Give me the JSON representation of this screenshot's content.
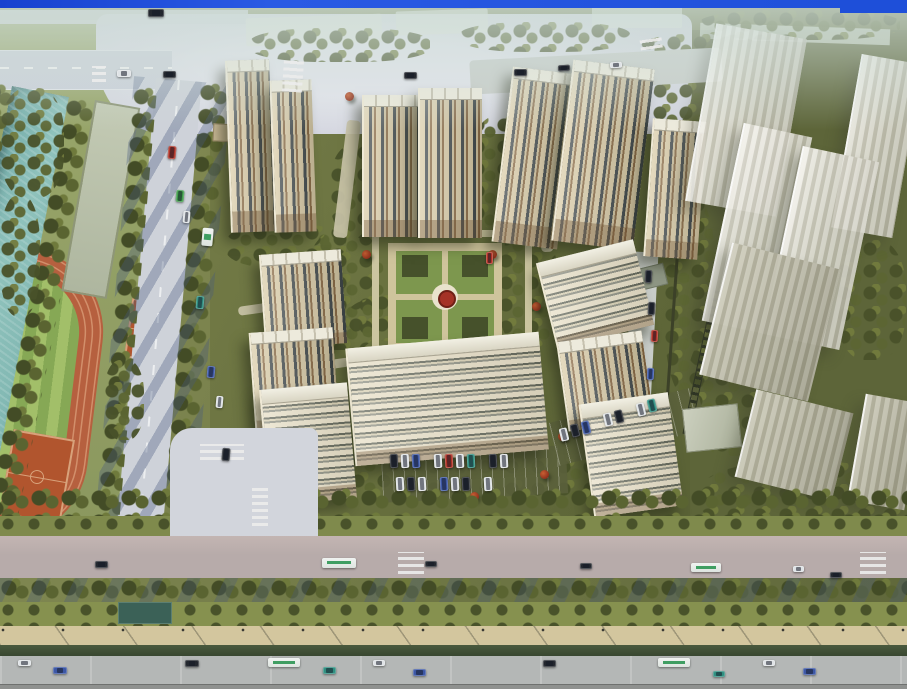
{
  "scene": {
    "type": "aerial-architectural-rendering",
    "description": "Bird's-eye rendering of a residential high-rise complex with central formal garden, canal and sports park to the west, translucent future-phase towers to the east, tree-lined arterial road along the south",
    "palette": {
      "frame_blue": "#1e4fd9",
      "water_teal": "#7fb5b0",
      "track_red": "#b6603f",
      "court_clay": "#b1552e",
      "field_green_light": "#a2bf69",
      "field_green_dark": "#86a855",
      "building_cream": "#d9cba6",
      "building_window": "#41494b",
      "building_roof_white": "#edeadc",
      "ghost_white": "#e8e6da",
      "ghost_olive": "#b0ae9a",
      "plaza_gray": "#d5d7e0",
      "road_gray": "#ccd1da",
      "arterial_gray": "#b4b7b6",
      "ground_olive": "#6b7342",
      "park_green": "#93a066",
      "lawn_green": "#86914f",
      "hedge_dark": "#3e4a33",
      "tree_olive": "#5a6431",
      "tree_dark": "#434c26",
      "shadow_blue": "#46587d",
      "accent_tree_red": "#a8442a",
      "path_tan": "#d3c69e",
      "garden_path": "#cfc49c",
      "garden_feature_red": "#a53226",
      "pond_teal": "#3b6157",
      "car_white": "#dfe3e6",
      "car_dark": "#23272e",
      "car_blue": "#3c57a6",
      "car_teal": "#2f8f80",
      "car_red": "#b03226",
      "car_green": "#3f9e49",
      "bus_green": "#3f9e62"
    },
    "main_buildings": [
      {
        "x": 228,
        "y": 60,
        "w": 42,
        "h": 172,
        "r": -2
      },
      {
        "x": 272,
        "y": 80,
        "w": 40,
        "h": 152,
        "r": -2
      },
      {
        "x": 362,
        "y": 95,
        "w": 58,
        "h": 142,
        "r": 0
      },
      {
        "x": 418,
        "y": 88,
        "w": 62,
        "h": 150,
        "r": 0
      },
      {
        "x": 502,
        "y": 70,
        "w": 64,
        "h": 176,
        "r": 7
      },
      {
        "x": 562,
        "y": 64,
        "w": 80,
        "h": 182,
        "r": 7
      },
      {
        "x": 648,
        "y": 120,
        "w": 52,
        "h": 138,
        "r": 4
      },
      {
        "x": 262,
        "y": 252,
        "w": 80,
        "h": 94,
        "r": -4
      },
      {
        "x": 252,
        "y": 330,
        "w": 82,
        "h": 100,
        "r": -4
      },
      {
        "x": 545,
        "y": 250,
        "w": 98,
        "h": 88,
        "r": -14,
        "v": "lit"
      },
      {
        "x": 562,
        "y": 336,
        "w": 84,
        "h": 90,
        "r": -8
      },
      {
        "x": 350,
        "y": 340,
        "w": 192,
        "h": 118,
        "r": -5,
        "v": "lit"
      },
      {
        "x": 264,
        "y": 386,
        "w": 86,
        "h": 116,
        "r": -5,
        "v": "lit"
      },
      {
        "x": 586,
        "y": 398,
        "w": 88,
        "h": 114,
        "r": -8,
        "v": "lit"
      }
    ],
    "ghost_buildings": [
      {
        "x": 700,
        "y": 30,
        "w": 90,
        "h": 180,
        "r": 10
      },
      {
        "x": 846,
        "y": 58,
        "w": 60,
        "h": 176,
        "r": 10
      },
      {
        "x": 722,
        "y": 128,
        "w": 68,
        "h": 202,
        "r": 12
      },
      {
        "x": 782,
        "y": 152,
        "w": 76,
        "h": 192,
        "r": 12
      },
      {
        "x": 714,
        "y": 254,
        "w": 110,
        "h": 136,
        "r": 14,
        "v": "olive"
      },
      {
        "x": 744,
        "y": 400,
        "w": 98,
        "h": 90,
        "r": 14,
        "v": "olive"
      },
      {
        "x": 856,
        "y": 398,
        "w": 56,
        "h": 108,
        "r": 10,
        "v": "olive"
      }
    ],
    "groves": [
      {
        "x": 250,
        "y": 28,
        "w": 180,
        "h": 34
      },
      {
        "x": 460,
        "y": 22,
        "w": 170,
        "h": 30
      },
      {
        "x": 640,
        "y": 34,
        "w": 120,
        "h": 34
      },
      {
        "x": 700,
        "y": 10,
        "w": 200,
        "h": 30
      },
      {
        "x": 226,
        "y": 224,
        "w": 120,
        "h": 44
      },
      {
        "x": 330,
        "y": 144,
        "w": 58,
        "h": 94
      },
      {
        "x": 470,
        "y": 116,
        "w": 64,
        "h": 114
      },
      {
        "x": 306,
        "y": 230,
        "w": 78,
        "h": 120
      },
      {
        "x": 498,
        "y": 230,
        "w": 60,
        "h": 118
      },
      {
        "x": 348,
        "y": 294,
        "w": 146,
        "h": 48
      },
      {
        "x": 298,
        "y": 428,
        "w": 126,
        "h": 62
      },
      {
        "x": 426,
        "y": 458,
        "w": 210,
        "h": 42
      },
      {
        "x": 238,
        "y": 150,
        "w": 40,
        "h": 80
      },
      {
        "x": 652,
        "y": 60,
        "w": 56,
        "h": 130
      },
      {
        "x": 664,
        "y": 196,
        "w": 52,
        "h": 200
      },
      {
        "x": 688,
        "y": 326,
        "w": 100,
        "h": 130
      },
      {
        "x": 700,
        "y": 462,
        "w": 207,
        "h": 70
      },
      {
        "x": 836,
        "y": 240,
        "w": 70,
        "h": 120
      },
      {
        "x": 0,
        "y": 88,
        "w": 64,
        "h": 110
      },
      {
        "x": 0,
        "y": 196,
        "w": 40,
        "h": 120
      },
      {
        "x": 104,
        "y": 360,
        "w": 40,
        "h": 80
      },
      {
        "x": 0,
        "y": 520,
        "w": 170,
        "h": 44
      }
    ],
    "paths": [
      {
        "x": 340,
        "y": 120,
        "w": 14,
        "h": 118,
        "r": 7
      },
      {
        "x": 538,
        "y": 150,
        "w": 12,
        "h": 102,
        "r": -4
      },
      {
        "x": 444,
        "y": 350,
        "w": 10,
        "h": 62
      },
      {
        "x": 326,
        "y": 354,
        "w": 94,
        "h": 9,
        "r": -8
      },
      {
        "x": 238,
        "y": 302,
        "w": 70,
        "h": 9,
        "r": -8
      },
      {
        "x": 628,
        "y": 252,
        "w": 26,
        "h": 172,
        "r": 3,
        "v": "road"
      },
      {
        "x": 470,
        "y": 54,
        "w": 252,
        "h": 34,
        "r": -3,
        "v": "road"
      }
    ],
    "accent_trees": [
      {
        "x": 345,
        "y": 92
      },
      {
        "x": 424,
        "y": 104
      },
      {
        "x": 522,
        "y": 204
      },
      {
        "x": 302,
        "y": 272
      },
      {
        "x": 532,
        "y": 302
      },
      {
        "x": 415,
        "y": 357
      },
      {
        "x": 558,
        "y": 432
      },
      {
        "x": 302,
        "y": 442
      },
      {
        "x": 470,
        "y": 492
      },
      {
        "x": 608,
        "y": 300
      },
      {
        "x": 362,
        "y": 250
      },
      {
        "x": 488,
        "y": 250
      },
      {
        "x": 330,
        "y": 478
      },
      {
        "x": 540,
        "y": 470
      },
      {
        "x": 652,
        "y": 214
      },
      {
        "x": 296,
        "y": 180
      }
    ],
    "crosswalks": [
      {
        "x": 283,
        "y": 58,
        "w": 20,
        "h": 34,
        "r": 4
      },
      {
        "x": 92,
        "y": 66,
        "w": 14,
        "h": 16
      },
      {
        "x": 200,
        "y": 444,
        "w": 44,
        "h": 16
      },
      {
        "x": 252,
        "y": 488,
        "w": 16,
        "h": 38
      },
      {
        "x": 398,
        "y": 552,
        "w": 26,
        "h": 22
      },
      {
        "x": 860,
        "y": 552,
        "w": 26,
        "h": 22
      },
      {
        "x": 640,
        "y": 36,
        "w": 22,
        "h": 13,
        "r": -8
      }
    ],
    "cars": [
      {
        "x": 117,
        "y": 70,
        "w": 14,
        "h": 7,
        "c": "#dfe3e6"
      },
      {
        "x": 163,
        "y": 71,
        "w": 13,
        "h": 7,
        "c": "#23272e"
      },
      {
        "x": 404,
        "y": 72,
        "w": 13,
        "h": 7,
        "c": "#23272e"
      },
      {
        "x": 514,
        "y": 69,
        "w": 13,
        "h": 7,
        "c": "#23272e"
      },
      {
        "x": 148,
        "y": 9,
        "w": 16,
        "h": 8,
        "c": "#23272e"
      },
      {
        "x": 558,
        "y": 65,
        "w": 12,
        "h": 6,
        "r": -3,
        "c": "#23272e"
      },
      {
        "x": 610,
        "y": 62,
        "w": 12,
        "h": 6,
        "r": -3,
        "c": "#dfe3e6"
      },
      {
        "x": 168,
        "y": 146,
        "w": 8,
        "h": 13,
        "r": 5,
        "c": "#b03226"
      },
      {
        "x": 176,
        "y": 190,
        "w": 8,
        "h": 12,
        "r": 5,
        "c": "#3f9e49"
      },
      {
        "x": 183,
        "y": 211,
        "w": 7,
        "h": 12,
        "r": 5,
        "c": "#dfe3e6"
      },
      {
        "x": 196,
        "y": 296,
        "w": 8,
        "h": 13,
        "r": 5,
        "c": "#2f8f80"
      },
      {
        "x": 207,
        "y": 366,
        "w": 8,
        "h": 12,
        "r": 5,
        "c": "#3c57a6"
      },
      {
        "x": 216,
        "y": 396,
        "w": 7,
        "h": 12,
        "r": 5,
        "c": "#dfe3e6"
      },
      {
        "x": 222,
        "y": 448,
        "w": 8,
        "h": 13,
        "r": 5,
        "c": "#23272e"
      },
      {
        "x": 645,
        "y": 270,
        "w": 7,
        "h": 13,
        "r": 3,
        "c": "#23272e"
      },
      {
        "x": 648,
        "y": 302,
        "w": 7,
        "h": 13,
        "r": 3,
        "c": "#23272e"
      },
      {
        "x": 651,
        "y": 330,
        "w": 7,
        "h": 12,
        "r": 3,
        "c": "#b03226"
      },
      {
        "x": 647,
        "y": 368,
        "w": 7,
        "h": 12,
        "r": 3,
        "c": "#3c57a6"
      },
      {
        "x": 486,
        "y": 252,
        "w": 7,
        "h": 12,
        "c": "#b03226"
      },
      {
        "x": 390,
        "y": 454,
        "w": 8,
        "h": 14,
        "r": -3,
        "c": "#23272e"
      },
      {
        "x": 401,
        "y": 454,
        "w": 8,
        "h": 14,
        "r": -3,
        "c": "#dfe3e6"
      },
      {
        "x": 412,
        "y": 454,
        "w": 8,
        "h": 14,
        "r": -3,
        "c": "#3c57a6"
      },
      {
        "x": 434,
        "y": 454,
        "w": 8,
        "h": 14,
        "r": -3,
        "c": "#dfe3e6"
      },
      {
        "x": 445,
        "y": 454,
        "w": 8,
        "h": 14,
        "r": -3,
        "c": "#b03226"
      },
      {
        "x": 456,
        "y": 454,
        "w": 8,
        "h": 14,
        "r": -3,
        "c": "#dfe3e6"
      },
      {
        "x": 467,
        "y": 454,
        "w": 8,
        "h": 14,
        "r": -3,
        "c": "#2f8f80"
      },
      {
        "x": 489,
        "y": 454,
        "w": 8,
        "h": 14,
        "r": -3,
        "c": "#23272e"
      },
      {
        "x": 500,
        "y": 454,
        "w": 8,
        "h": 14,
        "r": -3,
        "c": "#dfe3e6"
      },
      {
        "x": 396,
        "y": 477,
        "w": 8,
        "h": 14,
        "r": -3,
        "c": "#dfe3e6"
      },
      {
        "x": 407,
        "y": 477,
        "w": 8,
        "h": 14,
        "r": -3,
        "c": "#23272e"
      },
      {
        "x": 418,
        "y": 477,
        "w": 8,
        "h": 14,
        "r": -3,
        "c": "#dfe3e6"
      },
      {
        "x": 440,
        "y": 477,
        "w": 8,
        "h": 14,
        "r": -3,
        "c": "#3c57a6"
      },
      {
        "x": 451,
        "y": 477,
        "w": 8,
        "h": 14,
        "r": -3,
        "c": "#dfe3e6"
      },
      {
        "x": 462,
        "y": 477,
        "w": 8,
        "h": 14,
        "r": -3,
        "c": "#23272e"
      },
      {
        "x": 484,
        "y": 477,
        "w": 8,
        "h": 14,
        "r": -3,
        "c": "#dfe3e6"
      },
      {
        "x": 560,
        "y": 428,
        "w": 8,
        "h": 13,
        "r": -14,
        "c": "#dfe3e6"
      },
      {
        "x": 571,
        "y": 424,
        "w": 8,
        "h": 13,
        "r": -14,
        "c": "#23272e"
      },
      {
        "x": 582,
        "y": 421,
        "w": 8,
        "h": 13,
        "r": -14,
        "c": "#3c57a6"
      },
      {
        "x": 604,
        "y": 413,
        "w": 8,
        "h": 13,
        "r": -14,
        "c": "#dfe3e6"
      },
      {
        "x": 615,
        "y": 410,
        "w": 8,
        "h": 13,
        "r": -14,
        "c": "#23272e"
      },
      {
        "x": 637,
        "y": 403,
        "w": 8,
        "h": 13,
        "r": -14,
        "c": "#dfe3e6"
      },
      {
        "x": 648,
        "y": 399,
        "w": 8,
        "h": 13,
        "r": -14,
        "c": "#2f8f80"
      },
      {
        "x": 95,
        "y": 561,
        "w": 13,
        "h": 7,
        "c": "#23272e"
      },
      {
        "x": 425,
        "y": 561,
        "w": 12,
        "h": 6,
        "c": "#23272e"
      },
      {
        "x": 580,
        "y": 563,
        "w": 12,
        "h": 6,
        "c": "#23272e"
      },
      {
        "x": 793,
        "y": 566,
        "w": 11,
        "h": 6,
        "c": "#dfe3e6"
      },
      {
        "x": 830,
        "y": 572,
        "w": 12,
        "h": 6,
        "c": "#23272e"
      },
      {
        "x": 18,
        "y": 660,
        "w": 13,
        "h": 6,
        "c": "#dfe3e6"
      },
      {
        "x": 53,
        "y": 667,
        "w": 14,
        "h": 7,
        "c": "#3c57a6"
      },
      {
        "x": 185,
        "y": 660,
        "w": 14,
        "h": 7,
        "c": "#23272e"
      },
      {
        "x": 323,
        "y": 667,
        "w": 13,
        "h": 7,
        "c": "#2f8f80"
      },
      {
        "x": 373,
        "y": 660,
        "w": 12,
        "h": 6,
        "c": "#dfe3e6"
      },
      {
        "x": 413,
        "y": 669,
        "w": 13,
        "h": 7,
        "c": "#3c57a6"
      },
      {
        "x": 543,
        "y": 660,
        "w": 13,
        "h": 7,
        "c": "#23272e"
      },
      {
        "x": 713,
        "y": 671,
        "w": 12,
        "h": 6,
        "c": "#2f8f80"
      },
      {
        "x": 763,
        "y": 660,
        "w": 12,
        "h": 6,
        "c": "#dfe3e6"
      },
      {
        "x": 803,
        "y": 668,
        "w": 13,
        "h": 7,
        "c": "#3c57a6"
      }
    ],
    "buses": [
      {
        "x": 202,
        "y": 228,
        "w": 11,
        "h": 18,
        "r": 5
      },
      {
        "x": 322,
        "y": 558,
        "w": 34,
        "h": 10
      },
      {
        "x": 691,
        "y": 563,
        "w": 30,
        "h": 9
      },
      {
        "x": 268,
        "y": 658,
        "w": 32,
        "h": 9
      },
      {
        "x": 658,
        "y": 658,
        "w": 32,
        "h": 9
      }
    ]
  }
}
